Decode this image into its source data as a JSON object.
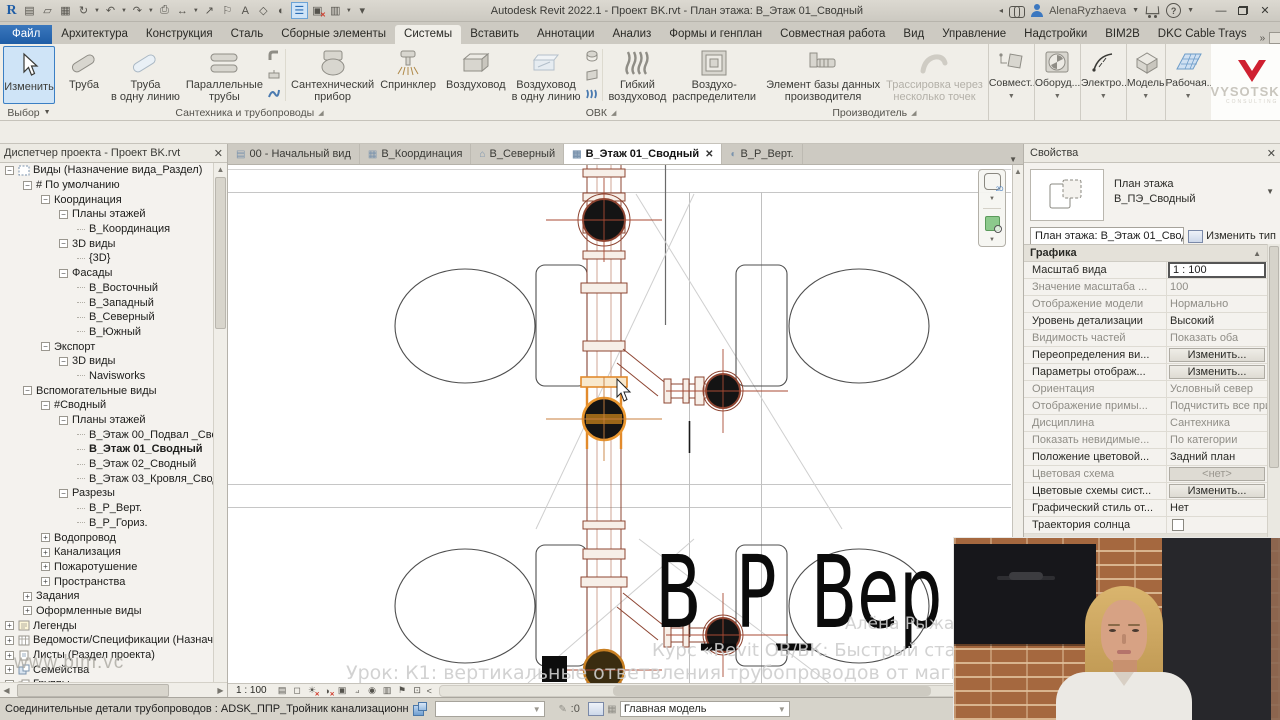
{
  "titlebar": {
    "title": "Autodesk Revit 2022.1 - Проект BK.rvt - План этажа: В_Этаж 01_Сводный",
    "user": "AlenaRyzhaeva",
    "qat_icons": [
      "revit-logo",
      "new-file-icon",
      "open-file-icon",
      "save-icon",
      "sync-icon",
      "undo-icon",
      "redo-icon",
      "print-icon",
      "measure-icon",
      "aligned-dimension-icon",
      "tag-icon",
      "text-icon",
      "default-3d-view-icon",
      "section-icon",
      "user-interface-icon",
      "close-hidden-windows-icon",
      "switch-windows-icon",
      "customize-qat-icon"
    ]
  },
  "ribbon": {
    "tabs": [
      "Файл",
      "Архитектура",
      "Конструкция",
      "Сталь",
      "Сборные элементы",
      "Системы",
      "Вставить",
      "Аннотации",
      "Анализ",
      "Формы и генплан",
      "Совместная работа",
      "Вид",
      "Управление",
      "Надстройки",
      "BIM2B",
      "DKC Cable Trays"
    ],
    "active_tab": "Системы",
    "modify_button": "Изменить",
    "select_panel": "Выбор",
    "panels": [
      {
        "name": "Сантехника и трубопроводы",
        "launcher": true,
        "groups": [
          {
            "buttons": [
              {
                "lines": [
                  "Труба"
                ],
                "icon": "pipe-icon"
              },
              {
                "lines": [
                  "Труба",
                  "в одну линию"
                ],
                "icon": "pipe-placeholder-icon"
              },
              {
                "lines": [
                  "Параллельные",
                  "трубы"
                ],
                "icon": "parallel-pipes-icon"
              },
              {
                "stack": [
                  "pipe-fitting-icon",
                  "pipe-accessory-icon",
                  "flex-pipe-icon"
                ]
              }
            ]
          },
          {
            "buttons": [
              {
                "lines": [
                  "Сантехнический",
                  "прибор"
                ],
                "icon": "plumbing-fixture-icon"
              },
              {
                "lines": [
                  "Спринклер"
                ],
                "icon": "sprinkler-icon"
              }
            ]
          }
        ]
      },
      {
        "name": "ОВК",
        "launcher": true,
        "groups": [
          {
            "buttons": [
              {
                "lines": [
                  "Воздуховод"
                ],
                "icon": "duct-icon"
              },
              {
                "lines": [
                  "Воздуховод",
                  "в одну линию"
                ],
                "icon": "duct-placeholder-icon"
              },
              {
                "stack": [
                  "duct-fitting-icon",
                  "duct-accessory-icon",
                  "flex-duct-small-icon"
                ]
              }
            ]
          },
          {
            "buttons": [
              {
                "lines": [
                  "Гибкий",
                  "воздуховод"
                ],
                "icon": "flex-duct-icon"
              },
              {
                "lines": [
                  "Воздухо-",
                  "распределители"
                ],
                "icon": "air-terminal-icon"
              }
            ]
          }
        ]
      },
      {
        "name": "Производитель",
        "launcher": true,
        "groups": [
          {
            "buttons": [
              {
                "lines": [
                  "Элемент базы данных",
                  "производителя"
                ],
                "icon": "mfg-part-icon"
              },
              {
                "lines": [
                  "Трассировка через",
                  "несколько точек"
                ],
                "icon": "multipoint-routing-icon",
                "disabled": true
              }
            ]
          }
        ]
      }
    ],
    "mini_panels": [
      {
        "label": "Совмест...",
        "icon": "collaborate-icon"
      },
      {
        "label": "Оборуд...",
        "icon": "equipment-icon"
      },
      {
        "label": "Электро...",
        "icon": "electrical-icon"
      },
      {
        "label": "Модель",
        "icon": "model-icon"
      },
      {
        "label": "Рабочая...",
        "icon": "workplane-icon"
      }
    ],
    "logo": {
      "brand": "VYSOTSKIY",
      "sub": "CONSULTING"
    }
  },
  "project_browser": {
    "title": "Диспетчер проекта - Проект BK.rvt",
    "watermark": "www.bim.vc",
    "tree": [
      {
        "t": "Виды (Назначение вида_Раздел)",
        "l": 0,
        "e": "-",
        "i": "views-icon"
      },
      {
        "t": "# По умолчанию",
        "l": 1,
        "e": "-"
      },
      {
        "t": "Координация",
        "l": 2,
        "e": "-"
      },
      {
        "t": "Планы этажей",
        "l": 3,
        "e": "-"
      },
      {
        "t": "В_Координация",
        "l": 4
      },
      {
        "t": "3D виды",
        "l": 3,
        "e": "-"
      },
      {
        "t": "{3D}",
        "l": 4
      },
      {
        "t": "Фасады",
        "l": 3,
        "e": "-"
      },
      {
        "t": "В_Восточный",
        "l": 4
      },
      {
        "t": "В_Западный",
        "l": 4
      },
      {
        "t": "В_Северный",
        "l": 4
      },
      {
        "t": "В_Южный",
        "l": 4
      },
      {
        "t": "Экспорт",
        "l": 2,
        "e": "-"
      },
      {
        "t": "3D виды",
        "l": 3,
        "e": "-"
      },
      {
        "t": "Navisworks",
        "l": 4
      },
      {
        "t": "Вспомогательные виды",
        "l": 1,
        "e": "-"
      },
      {
        "t": "#Сводный",
        "l": 2,
        "e": "-"
      },
      {
        "t": "Планы этажей",
        "l": 3,
        "e": "-"
      },
      {
        "t": "В_Этаж 00_Подвал _Сводн",
        "l": 4
      },
      {
        "t": "В_Этаж 01_Сводный",
        "l": 4,
        "b": true
      },
      {
        "t": "В_Этаж 02_Сводный",
        "l": 4
      },
      {
        "t": "В_Этаж 03_Кровля_Сводны",
        "l": 4
      },
      {
        "t": "Разрезы",
        "l": 3,
        "e": "-"
      },
      {
        "t": "В_Р_Верт.",
        "l": 4
      },
      {
        "t": "В_Р_Гориз.",
        "l": 4
      },
      {
        "t": "Водопровод",
        "l": 2,
        "e": "+"
      },
      {
        "t": "Канализация",
        "l": 2,
        "e": "+"
      },
      {
        "t": "Пожаротушение",
        "l": 2,
        "e": "+"
      },
      {
        "t": "Пространства",
        "l": 2,
        "e": "+"
      },
      {
        "t": "Задания",
        "l": 1,
        "e": "+"
      },
      {
        "t": "Оформленные виды",
        "l": 1,
        "e": "+"
      },
      {
        "t": "Легенды",
        "l": 0,
        "e": "+",
        "i": "legend-icon"
      },
      {
        "t": "Ведомости/Спецификации (Назначен",
        "l": 0,
        "e": "+",
        "i": "schedule-icon"
      },
      {
        "t": "Листы (Раздел проекта)",
        "l": 0,
        "e": "+",
        "i": "sheet-icon"
      },
      {
        "t": "Семейства",
        "l": 0,
        "e": "+",
        "i": "family-icon"
      },
      {
        "t": "Группы",
        "l": 0,
        "e": "+",
        "i": "group-icon"
      }
    ]
  },
  "view_tabs": [
    {
      "label": "00 - Начальный вид",
      "icon": "start-page-icon"
    },
    {
      "label": "В_Координация",
      "icon": "plan-view-icon"
    },
    {
      "label": "В_Северный",
      "icon": "elevation-view-icon"
    },
    {
      "label": "В_Этаж 01_Сводный",
      "icon": "plan-view-icon",
      "active": true,
      "close": "✕"
    },
    {
      "label": "В_Р_Верт.",
      "icon": "section-view-icon"
    }
  ],
  "canvas": {
    "big_label": "В_Р_Вер",
    "watermark_author": "Алёна Рыжаева",
    "watermark_course": "Курс «Revit ОВ/ВК: Быстрый старт»",
    "watermark_lesson": "Урок: К1: вертикальные ответвления трубопроводов от магистрали",
    "scale": "1 : 100"
  },
  "view_control_icons": [
    "detail-level-icon",
    "visual-style-icon",
    "sun-path-icon",
    "shadows-icon",
    "crop-view-icon",
    "show-crop-icon",
    "reveal-hidden-icon",
    "temporary-hide-icon",
    "worksharing-display-icon",
    "constraints-icon"
  ],
  "properties": {
    "title": "Свойства",
    "type_preview": {
      "line1": "План этажа",
      "line2": "В_ПЭ_Сводный"
    },
    "type_selector": "План этажа: В_Этаж 01_Сводный",
    "edit_type_label": "Изменить тип",
    "groups": [
      {
        "name": "Графика",
        "rows": [
          {
            "label": "Масштаб вида",
            "value": "1 : 100",
            "kind": "edit"
          },
          {
            "label": "Значение масштаба   ...",
            "value": "100",
            "muted": true
          },
          {
            "label": "Отображение модели",
            "value": "Нормально",
            "muted": true
          },
          {
            "label": "Уровень детализации",
            "value": "Высокий"
          },
          {
            "label": "Видимость частей",
            "value": "Показать оба",
            "muted": true
          },
          {
            "label": "Переопределения ви...",
            "value": "Изменить...",
            "kind": "button"
          },
          {
            "label": "Параметры отображ...",
            "value": "Изменить...",
            "kind": "button"
          },
          {
            "label": "Ориентация",
            "value": "Условный север",
            "muted": true
          },
          {
            "label": "Отображение примы...",
            "value": "Подчистить все прим...",
            "muted": true
          },
          {
            "label": "Дисциплина",
            "value": "Сантехника",
            "muted": true
          },
          {
            "label": "Показать невидимые...",
            "value": "По категории",
            "muted": true
          },
          {
            "label": "Положение цветовой...",
            "value": "Задний план"
          },
          {
            "label": "Цветовая схема",
            "value": "<нет>",
            "kind": "button-dim",
            "muted": true
          },
          {
            "label": "Цветовые схемы сист...",
            "value": "Изменить...",
            "kind": "button"
          },
          {
            "label": "Графический стиль от...",
            "value": "Нет"
          },
          {
            "label": "Траектория солнца",
            "value": "",
            "kind": "checkbox"
          }
        ]
      },
      {
        "name": "Подложка",
        "rows": [
          {
            "label": "Диапазон: нижний ур...",
            "value": "Нет"
          }
        ]
      }
    ]
  },
  "statusbar": {
    "hint": "Соединительные детали трубопроводов : ADSK_ППР_Тройник канализационн",
    "counter_value": ":0",
    "model_selector": "Главная модель"
  },
  "colors": {
    "accent_blue": "#1f5da6",
    "selection_orange": "#e28a2c",
    "pipe_brown": "#8d4431",
    "logo_red": "#cf2030"
  }
}
